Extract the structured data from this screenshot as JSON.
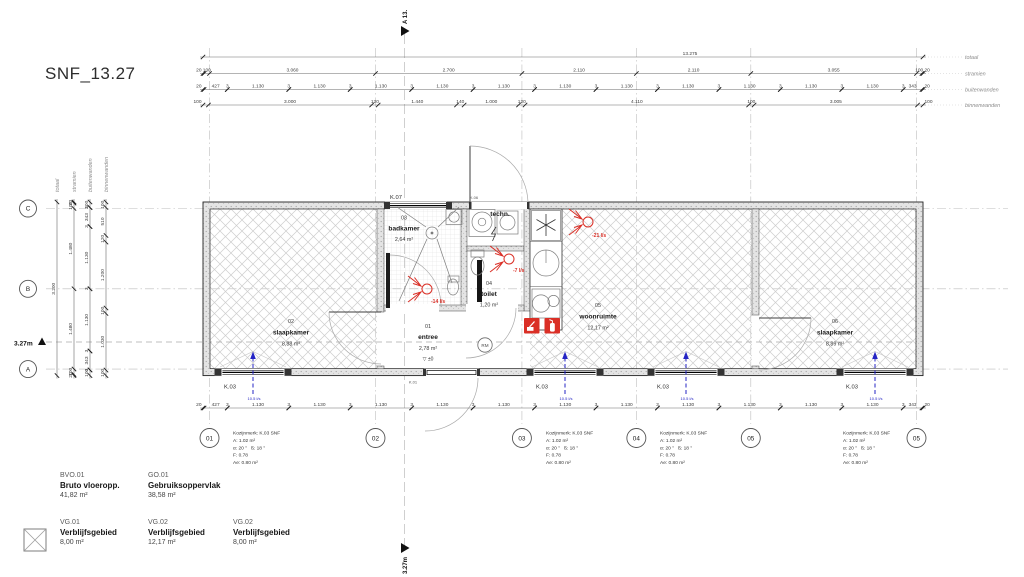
{
  "title": "SNF_13.27",
  "row_labels": {
    "totaal": "totaal",
    "stramien": "stramien",
    "buitenwanden": "buitenwanden",
    "binnenwanden": "binnenwanden"
  },
  "dims": {
    "top": {
      "totaal": [
        "13.275"
      ],
      "stramien": [
        "20",
        "100",
        "3.060",
        "2.700",
        "2.110",
        "2.110",
        "3.055",
        "100",
        "20"
      ],
      "buitenwanden": [
        "20",
        "427",
        "3",
        "1.130",
        "3",
        "1.130",
        "3",
        "1.130",
        "3",
        "1.130",
        "3",
        "1.130",
        "3",
        "1.130",
        "3",
        "1.130",
        "3",
        "1.130",
        "3",
        "1.130",
        "3",
        "1.130",
        "3",
        "1.130",
        "3",
        "343",
        "20"
      ],
      "binnenwanden": [
        "100",
        "3.000",
        "120",
        "1.440",
        "140",
        "1.000",
        "120",
        "4.110",
        "100",
        "3.005",
        "100"
      ]
    },
    "bottom": {
      "buitenwanden": [
        "20",
        "427",
        "3",
        "1.130",
        "3",
        "1.130",
        "3",
        "1.130",
        "3",
        "1.130",
        "3",
        "1.130",
        "3",
        "1.130",
        "3",
        "1.130",
        "3",
        "1.130",
        "3",
        "1.130",
        "3",
        "1.130",
        "3",
        "1.130",
        "3",
        "343",
        "20"
      ]
    },
    "left": {
      "totaal": [
        "3.200"
      ],
      "stramien": [
        "20",
        "100",
        "1.480",
        "1.480",
        "100",
        "20"
      ],
      "buitenwanden": [
        "100",
        "3",
        "343",
        "3",
        "1.130",
        "3",
        "1.130",
        "3",
        "343",
        "3",
        "100"
      ],
      "binnenwanden": [
        "100",
        "510",
        "120",
        "1.200",
        "100",
        "1.030",
        "100"
      ]
    }
  },
  "grid": {
    "rows": [
      "C",
      "B",
      "A"
    ],
    "cols": [
      "01",
      "02",
      "03",
      "04",
      "05",
      "05"
    ]
  },
  "rooms": [
    {
      "num": "02",
      "name": "slaapkamer",
      "area": "8,88 m²"
    },
    {
      "num": "03",
      "name": "badkamer",
      "area": "2,64 m²"
    },
    {
      "num": "01",
      "name": "entree",
      "area": "2,78 m²"
    },
    {
      "num": "04",
      "name": "toilet",
      "area": "1,20 m²"
    },
    {
      "num": "05",
      "name": "woonruimte",
      "area": "12,17 m²"
    },
    {
      "num": "06",
      "name": "slaapkamer",
      "area": "8,89 m²"
    },
    {
      "num": "",
      "name": "techn.",
      "area": ""
    }
  ],
  "k_labels": {
    "k07": "K.07",
    "k06": "K.06",
    "k01": "K.01",
    "k03": "K.03"
  },
  "vent": {
    "extract": [
      "-14 l/s",
      "-7 l/s",
      "-21 l/s"
    ],
    "supply": "10.5 l/s"
  },
  "markers": {
    "left_level": "3.27m",
    "section_top": "A 13.",
    "section_bottom": "3.27m",
    "entree_level": "▽ ±0",
    "smoke_detector": "RM"
  },
  "kozijn_note": {
    "title": "Kozijnmerk: K.03 SNF",
    "area": "A: 1.02 m²",
    "angles": "α: 20 °   ß: 18 °",
    "f": "F: 0.78",
    "ae": "Ae: 0.80 m²"
  },
  "legend": {
    "bvo": {
      "code": "BVO.01",
      "name": "Bruto vloeropp.",
      "value": "41,82 m²"
    },
    "go": {
      "code": "GO.01",
      "name": "Gebruiksoppervlak",
      "value": "38,58 m²"
    },
    "vg": [
      {
        "code": "VG.01",
        "name": "Verblijfsgebied",
        "value": "8,00 m²"
      },
      {
        "code": "VG.02",
        "name": "Verblijfsgebied",
        "value": "12,17 m²"
      },
      {
        "code": "VG.02",
        "name": "Verblijfsgebied",
        "value": "8,00 m²"
      }
    ]
  },
  "colors": {
    "red": "#da2f26",
    "blue": "#2424c4",
    "grid_line": "#bdbdbd",
    "wall_fill": "#e3e3e3",
    "hatch": "#cdcdcd"
  }
}
